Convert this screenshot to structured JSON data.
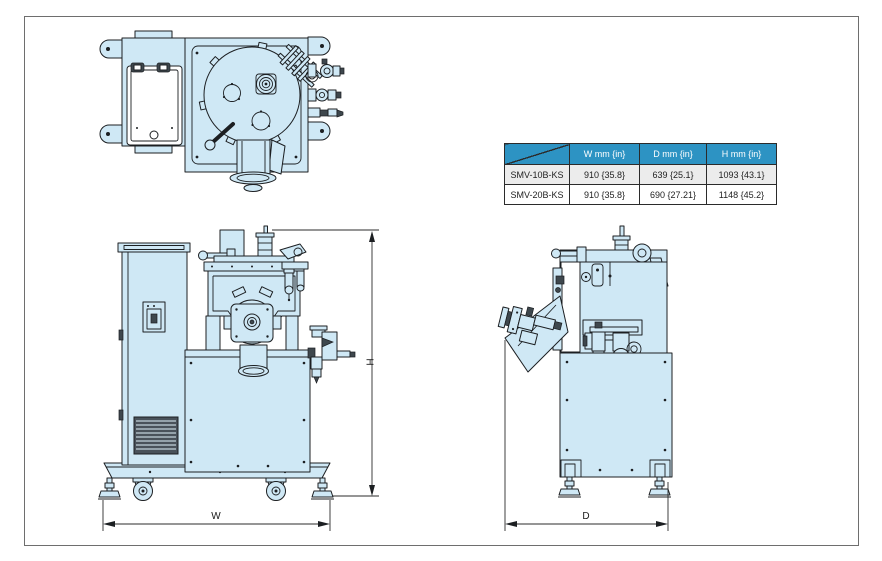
{
  "colors": {
    "machine_fill": "#cfe8f5",
    "line": "#1c1f22",
    "dark_fill": "#3e474d",
    "frame_border": "#6e6e6e",
    "dim_line": "#2b2b2b",
    "table_header_bg": "#2d93c3",
    "table_header_text": "#ffffff",
    "table_border": "#2b2b2b",
    "table_row_alt_bg": "#ececec"
  },
  "spec_table": {
    "corner_label": "",
    "columns": [
      "W mm {in}",
      "D mm {in}",
      "H mm {in}"
    ],
    "rows": [
      {
        "model": "SMV-10B-KS",
        "values": [
          "910 {35.8}",
          "639 {25.1}",
          "1093 {43.1}"
        ]
      },
      {
        "model": "SMV-20B-KS",
        "values": [
          "910 {35.8}",
          "690 {27.21}",
          "1148 {45.2}"
        ]
      }
    ]
  },
  "dimensions": {
    "width_label": "W",
    "depth_label": "D",
    "height_label": "H"
  }
}
